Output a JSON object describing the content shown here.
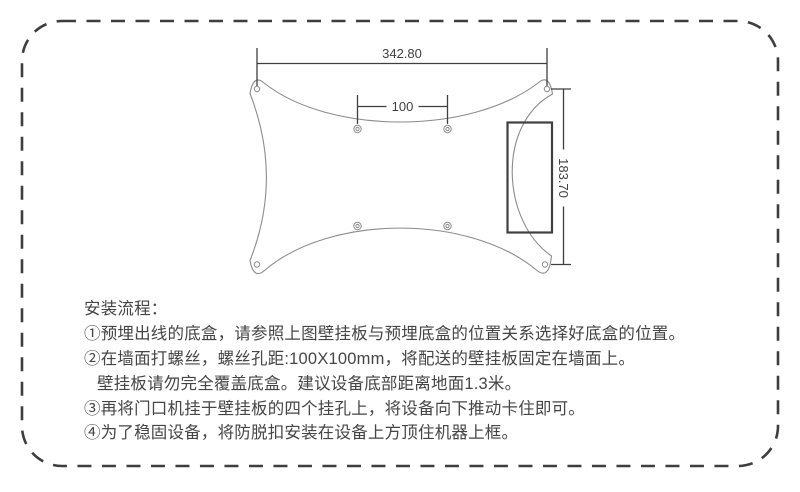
{
  "page": {
    "background": "#ffffff",
    "border_color": "#3e3e3e"
  },
  "colors": {
    "plate_outline": "#8c8c8c",
    "dimension_lines": "#3f3f3f",
    "junction_box": "#3f3f3f",
    "instruction_text": "#454545"
  },
  "diagram": {
    "dim_width": {
      "label": "342.80"
    },
    "dim_spacing": {
      "label": "100"
    },
    "dim_height": {
      "label": "183.70"
    }
  },
  "instructions": {
    "heading": "安装流程：",
    "steps": [
      {
        "text": "①预埋出线的底盒，请参照上图壁挂板与预埋底盒的位置关系选择好底盒的位置。"
      },
      {
        "text": "②在墙面打螺丝，螺丝孔距:100X100mm，将配送的壁挂板固定在墙面上。"
      },
      {
        "text": "壁挂板请勿完全覆盖底盒。建议设备底部距离地面1.3米。"
      },
      {
        "text": "③再将门口机挂于壁挂板的四个挂孔上，将设备向下推动卡住即可。"
      },
      {
        "text": "④为了稳固设备，将防脱扣安装在设备上方顶住机器上框。"
      }
    ]
  }
}
